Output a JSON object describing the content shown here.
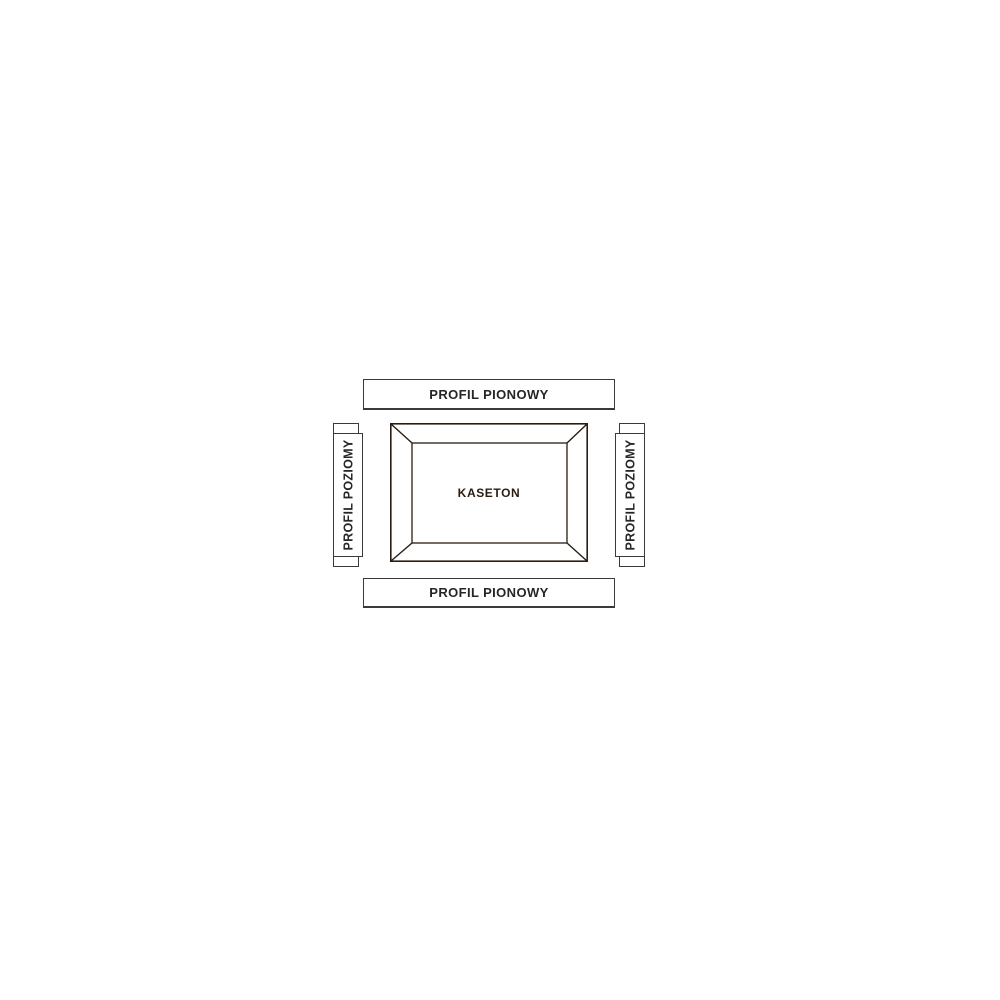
{
  "diagram": {
    "type": "assembly-diagram",
    "labels": {
      "top": "PROFIL PIONOWY",
      "bottom": "PROFIL PIONOWY",
      "left": "PROFIL POZIOMY",
      "right": "PROFIL POZIOMY",
      "center": "KASETON"
    },
    "colors": {
      "background": "#ffffff",
      "panel_fill": "#cca37a",
      "panel_line": "#2a1d11",
      "label_box_border": "#3a3a3a",
      "label_text": "#262626"
    }
  }
}
